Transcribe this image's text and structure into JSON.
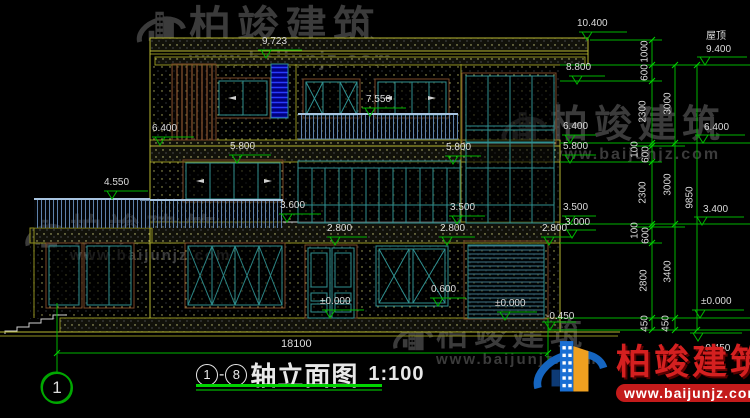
{
  "drawing_title": {
    "bubble_left": "1",
    "dash": "-",
    "bubble_right": "8",
    "name": "轴立面图",
    "scale": "1:100"
  },
  "axis_bubble_bottom_left": "1",
  "overall_dimension": "18100",
  "extra_labels": [
    {
      "text": "屋顶",
      "x": 706,
      "y": 31
    }
  ],
  "levels": [
    {
      "text": "10.400",
      "tx": 587,
      "ty": 40,
      "lw": 40,
      "lx": 577,
      "ly": 18
    },
    {
      "text": "9.723",
      "tx": 266,
      "ty": 58,
      "lw": 36,
      "lx": 262,
      "ly": 36
    },
    {
      "text": "8.800",
      "tx": 577,
      "ty": 84,
      "lw": 28,
      "lx": 566,
      "ly": 62
    },
    {
      "text": "7.550",
      "tx": 370,
      "ty": 116,
      "lw": 36,
      "lx": 366,
      "ly": 94
    },
    {
      "text": "6.400",
      "tx": 160,
      "ty": 145,
      "lw": 34,
      "lx": 152,
      "ly": 123
    },
    {
      "text": "6.400",
      "tx": 570,
      "ty": 143,
      "lw": 26,
      "lx": 563,
      "ly": 121
    },
    {
      "text": "5.800",
      "tx": 237,
      "ty": 163,
      "lw": 34,
      "lx": 230,
      "ly": 141
    },
    {
      "text": "5.800",
      "tx": 453,
      "ty": 164,
      "lw": 28,
      "lx": 446,
      "ly": 142
    },
    {
      "text": "5.800",
      "tx": 570,
      "ty": 163,
      "lw": 26,
      "lx": 563,
      "ly": 141
    },
    {
      "text": "4.550",
      "tx": 112,
      "ty": 199,
      "lw": 36,
      "lx": 104,
      "ly": 177
    },
    {
      "text": "3.600",
      "tx": 287,
      "ty": 222,
      "lw": 34,
      "lx": 280,
      "ly": 200
    },
    {
      "text": "3.500",
      "tx": 457,
      "ty": 224,
      "lw": 28,
      "lx": 450,
      "ly": 202
    },
    {
      "text": "3.500",
      "tx": 570,
      "ty": 224,
      "lw": 26,
      "lx": 563,
      "ly": 202
    },
    {
      "text": "3.000",
      "tx": 572,
      "ty": 238,
      "lw": 24,
      "lx": 565,
      "ly": 217
    },
    {
      "text": "2.800",
      "tx": 335,
      "ty": 245,
      "lw": 32,
      "lx": 327,
      "ly": 223
    },
    {
      "text": "2.800",
      "tx": 447,
      "ty": 245,
      "lw": 28,
      "lx": 440,
      "ly": 223
    },
    {
      "text": "2.800",
      "tx": 549,
      "ty": 245,
      "lw": 24,
      "lx": 542,
      "ly": 223
    },
    {
      "text": "0.600",
      "tx": 438,
      "ty": 306,
      "lw": 28,
      "lx": 431,
      "ly": 284
    },
    {
      "text": "±0.000",
      "tx": 330,
      "ty": 318,
      "lw": 34,
      "lx": 320,
      "ly": 296
    },
    {
      "text": "±0.000",
      "tx": 505,
      "ty": 320,
      "lw": 32,
      "lx": 495,
      "ly": 298
    },
    {
      "text": "-0.450",
      "tx": 550,
      "ty": 330,
      "lw": 26,
      "lx": 546,
      "ly": 311
    },
    {
      "text": "9.400",
      "tx": 705,
      "ty": 65,
      "lw": 42,
      "lx": 706,
      "ly": 44
    },
    {
      "text": "6.400",
      "tx": 703,
      "ty": 143,
      "lw": 42,
      "lx": 704,
      "ly": 122
    },
    {
      "text": "3.400",
      "tx": 702,
      "ty": 225,
      "lw": 42,
      "lx": 703,
      "ly": 204
    },
    {
      "text": "±0.000",
      "tx": 700,
      "ty": 318,
      "lw": 44,
      "lx": 701,
      "ly": 296
    },
    {
      "text": "-0.450",
      "tx": 698,
      "ty": 341,
      "lw": 44,
      "lx": 702,
      "ly": 343
    }
  ],
  "vertical_dims": [
    {
      "text": "1000",
      "cx": 645,
      "cy": 52
    },
    {
      "text": "600",
      "cx": 645,
      "cy": 73
    },
    {
      "text": "2300",
      "cx": 643,
      "cy": 112
    },
    {
      "text": "100",
      "cx": 635,
      "cy": 150
    },
    {
      "text": "600",
      "cx": 646,
      "cy": 155
    },
    {
      "text": "2300",
      "cx": 643,
      "cy": 193
    },
    {
      "text": "100",
      "cx": 635,
      "cy": 231
    },
    {
      "text": "600",
      "cx": 646,
      "cy": 236
    },
    {
      "text": "2800",
      "cx": 644,
      "cy": 281
    },
    {
      "text": "450",
      "cx": 645,
      "cy": 324
    },
    {
      "text": "3000",
      "cx": 668,
      "cy": 104
    },
    {
      "text": "3000",
      "cx": 668,
      "cy": 185
    },
    {
      "text": "3400",
      "cx": 668,
      "cy": 272
    },
    {
      "text": "450",
      "cx": 666,
      "cy": 324
    },
    {
      "text": "9850",
      "cx": 690,
      "cy": 198
    }
  ],
  "watermarks": [
    {
      "cn": "柏竣建筑",
      "url": "www.baijunjz.com",
      "x": 133,
      "y": 5,
      "cn_size": 42,
      "url_size": 20,
      "glyph": 56
    },
    {
      "cn": "柏竣建筑",
      "url": "www.baijunjz.com",
      "x": 22,
      "y": 214,
      "cn_size": 32,
      "url_size": 15,
      "glyph": 48
    },
    {
      "cn": "柏竣建筑",
      "url": "www.baijunjz.com",
      "x": 498,
      "y": 106,
      "cn_size": 38,
      "url_size": 16,
      "glyph": 52
    },
    {
      "cn": "柏竣建筑",
      "url": "www.baijunjz.com",
      "x": 390,
      "y": 318,
      "cn_size": 32,
      "url_size": 15,
      "glyph": 46
    }
  ],
  "brand_logo": {
    "cn": "柏竣建筑",
    "url": "www.baijunjz.com"
  },
  "colors": {
    "dim_green": "#00b400",
    "bright_green": "#00d400",
    "frame_teal": "#2f9090",
    "wall_yellow": "#8f8f1f",
    "trim_brown": "#7a4928",
    "stair_blue": "#2a3cff",
    "text_white": "#dcdcdc",
    "watermark_gray": "#3b3b3b",
    "logo_red": "#d42020",
    "logo_blue": "#1565c0",
    "logo_orange": "#f0a020"
  }
}
